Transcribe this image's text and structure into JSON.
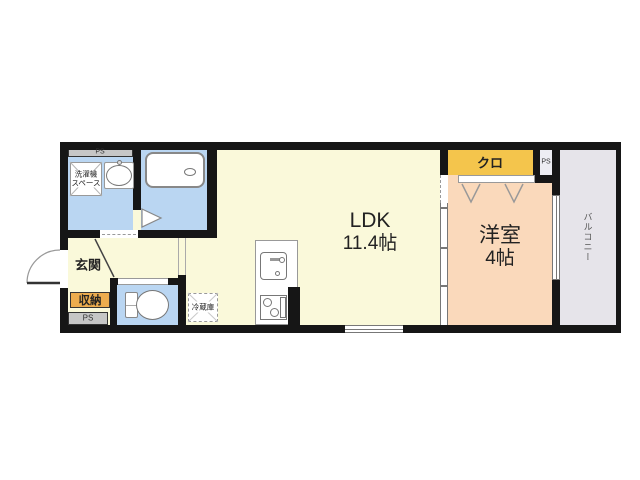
{
  "rooms": {
    "ldk": {
      "name": "LDK",
      "size": "11.4帖"
    },
    "bedroom": {
      "name": "洋室",
      "size": "4帖"
    },
    "closet": {
      "label": "クロ"
    },
    "entrance": {
      "label": "玄関"
    },
    "storage": {
      "label": "収納"
    },
    "balcony": {
      "label": "バルコニー"
    },
    "washer_space": {
      "line1": "洗濯機",
      "line2": "スペース"
    },
    "fridge": {
      "label": "冷蔵庫"
    },
    "pipe_space_top": {
      "label": "PS"
    },
    "pipe_space_bottom": {
      "label": "PS"
    },
    "pipe_space_right": {
      "label": "PS"
    }
  },
  "colors": {
    "wall": "#161616",
    "cream": "#FAF9DA",
    "peach": "#FAD9BB",
    "gold": "#F4C54C",
    "storage_gold": "#ECAC4E",
    "water_blue": "#BAD6F2",
    "balcony_gray": "#E6E4EA",
    "ps_gray": "#C6C6C6",
    "ps_light": "#EDEDF3"
  }
}
